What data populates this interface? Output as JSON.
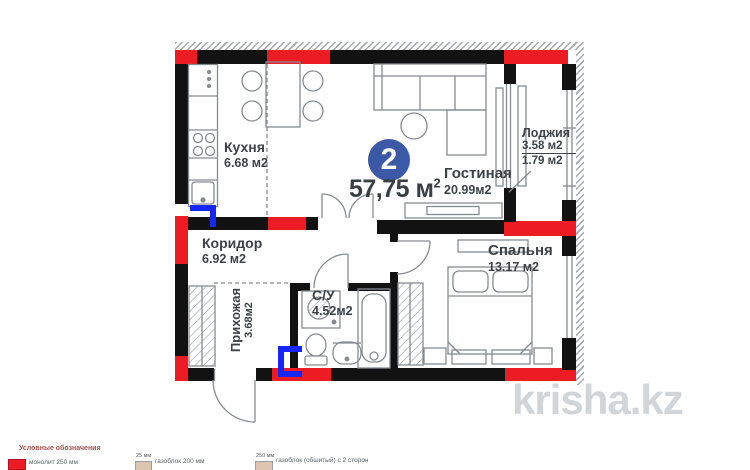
{
  "floorplan": {
    "badge_number": "2",
    "total_area": "57,75 м",
    "total_area_sup": "2",
    "rooms": {
      "kitchen": {
        "name": "Кухня",
        "area": "6.68 м2"
      },
      "living": {
        "name": "Гостиная",
        "area": "20.99м2"
      },
      "loggia": {
        "name": "Лоджия",
        "area_full": "3.58 м2",
        "area_reduced": "1.79 м2"
      },
      "corridor": {
        "name": "Коридор",
        "area": "6.92 м2"
      },
      "hallway": {
        "name": "Прихожая",
        "area": "3.68м2"
      },
      "bathroom": {
        "name": "С/У",
        "area": "4.52м2"
      },
      "bedroom": {
        "name": "Спальня",
        "area": "13.17 м2"
      }
    }
  },
  "legend": {
    "title": "Условные обозначения",
    "items": [
      {
        "label": "монолит 250 мм",
        "swatch": "#ec1c24"
      },
      {
        "size": "25 мм",
        "label": "газоблок 200 мм",
        "swatch": "#dcc5b1"
      },
      {
        "size": "250 мм",
        "label": "газоблок (обшитый) с 2 сторон",
        "swatch": "#dcc5b1"
      }
    ]
  },
  "watermark": "krisha.kz",
  "colors": {
    "monolith_red": "#ec1c24",
    "badge_blue": "#3c59a7",
    "duct_blue": "#1526f5",
    "line_gray": "#868b90",
    "watermark_gray": "#d2d5d8"
  }
}
